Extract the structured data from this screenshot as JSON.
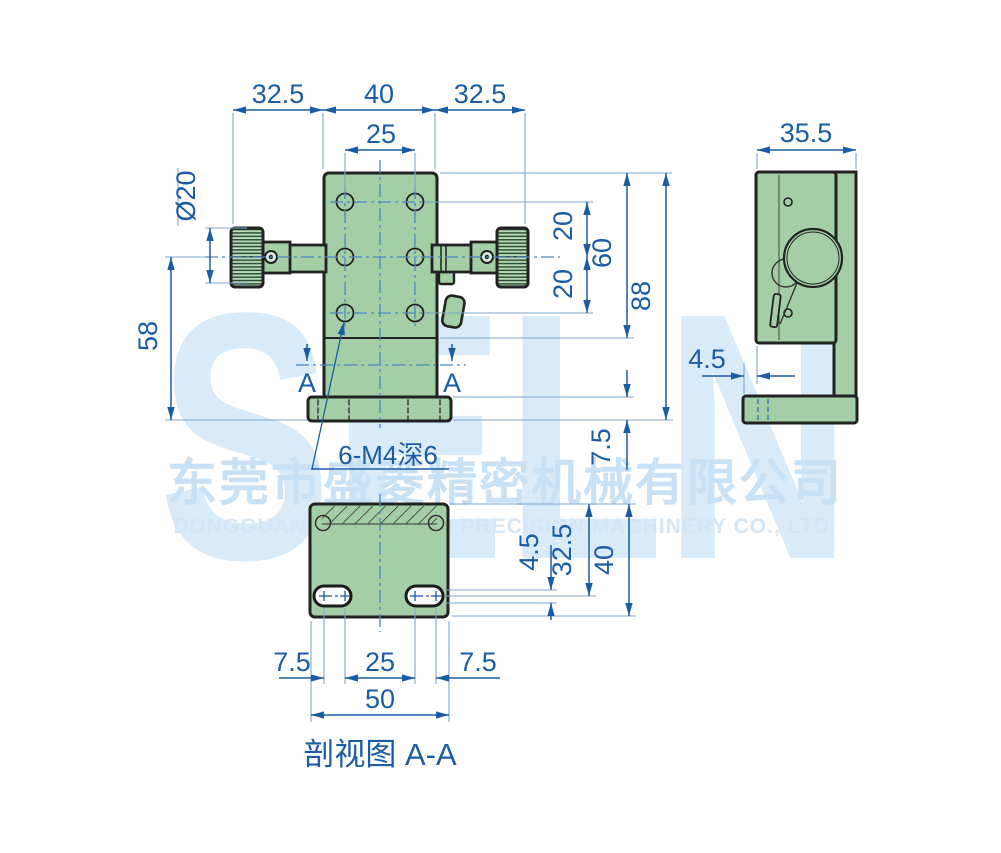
{
  "drawing": {
    "title_hint": "2D engineering drawing of a manual linear translation stage",
    "dims": {
      "top_left": "32.5",
      "top_mid": "40",
      "top_right": "32.5",
      "hole_span": "25",
      "knob_dia": "Ø20",
      "left_58": "58",
      "right_20_upper": "20",
      "right_20_lower": "20",
      "right_60": "60",
      "right_88": "88",
      "base_7_5": "7.5",
      "side_width": "35.5",
      "side_4_5": "4.5",
      "sect_slot_4_5": "4.5",
      "sect_32_5": "32.5",
      "sect_40": "40",
      "sect_7_5_left": "7.5",
      "sect_25": "25",
      "sect_7_5_right": "7.5",
      "sect_50": "50"
    },
    "labels": {
      "section_marker_left": "A",
      "section_marker_right": "A",
      "thread_note": "6-M4深6",
      "section_caption": "剖视图 A-A"
    },
    "watermark": {
      "logo": "SELN",
      "company_cn": "东莞市盛菱精密机械有限公司",
      "company_en": "DONGGUAN SHENG LING PRECISION MACHINERY CO., LTD."
    },
    "colors": {
      "dimension_blue": "#1b5ca6",
      "extension_blue": "#7fa5cc",
      "centerline_blue": "#4a86c2",
      "part_green": "#a4cfa6",
      "outline_dark": "#222222",
      "watermark_blue": "#c9e1f5"
    }
  }
}
